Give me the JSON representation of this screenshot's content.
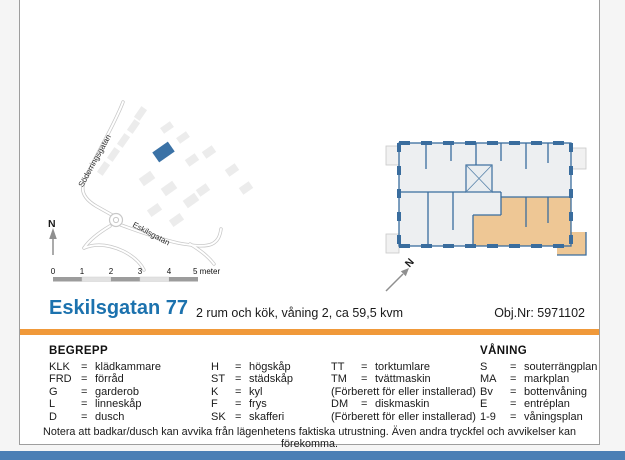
{
  "page": {
    "title": "Eskilsgatan 77",
    "subtitle": "2 rum och kök, våning 2, ca 59,5 kvm",
    "object_number": "Obj.Nr: 5971102"
  },
  "map": {
    "street_primary": "Söderringsgatan",
    "street_secondary": "Eskilsgatan",
    "north_label": "N",
    "scale": {
      "labels": [
        "0",
        "1",
        "2",
        "3",
        "4"
      ],
      "unit_label": "5 meter"
    }
  },
  "floorplan": {
    "north_label": "N"
  },
  "legend": {
    "heading": "BEGREPP",
    "floor_heading": "VÅNING",
    "eq": "=",
    "col1": [
      {
        "abbr": "KLK",
        "term": "klädkammare"
      },
      {
        "abbr": "FRD",
        "term": "förråd"
      },
      {
        "abbr": "G",
        "term": "garderob"
      },
      {
        "abbr": "L",
        "term": "linneskåp"
      },
      {
        "abbr": "D",
        "term": "dusch"
      }
    ],
    "col2": [
      {
        "abbr": "H",
        "term": "högskåp"
      },
      {
        "abbr": "ST",
        "term": "städskåp"
      },
      {
        "abbr": "K",
        "term": "kyl"
      },
      {
        "abbr": "F",
        "term": "frys"
      },
      {
        "abbr": "SK",
        "term": "skafferi"
      }
    ],
    "col3": [
      {
        "abbr": "TT",
        "term": "torktumlare"
      },
      {
        "abbr": "TM",
        "term": "tvättmaskin"
      },
      {
        "note": "(Förberett för eller installerad)"
      },
      {
        "abbr": "DM",
        "term": "diskmaskin"
      },
      {
        "note": "(Förberett för eller installerad)"
      }
    ],
    "col4": [
      {
        "abbr": "S",
        "term": "souterrängplan"
      },
      {
        "abbr": "MA",
        "term": "markplan"
      },
      {
        "abbr": "Bv",
        "term": "bottenvåning"
      },
      {
        "abbr": "E",
        "term": "entréplan"
      },
      {
        "abbr": "1-9",
        "term": "våningsplan"
      }
    ]
  },
  "footer": {
    "note": "Notera att badkar/dusch kan avvika från lägenhetens faktiska utrustning. Även andra tryckfel och avvikelser kan förekomma."
  },
  "colors": {
    "title_blue": "#1c72ae",
    "accent_orange": "#f0993a",
    "bottom_bar_blue": "#4b7fb5",
    "wall_blue": "#3a6d9e",
    "apartment_orange": "#eec795",
    "plan_bg": "#edeff1",
    "map_building_gray": "#ececec",
    "map_building_blue": "#3b72a6",
    "scale_dark": "#9c9c9c",
    "scale_light": "#e2e2e2"
  }
}
